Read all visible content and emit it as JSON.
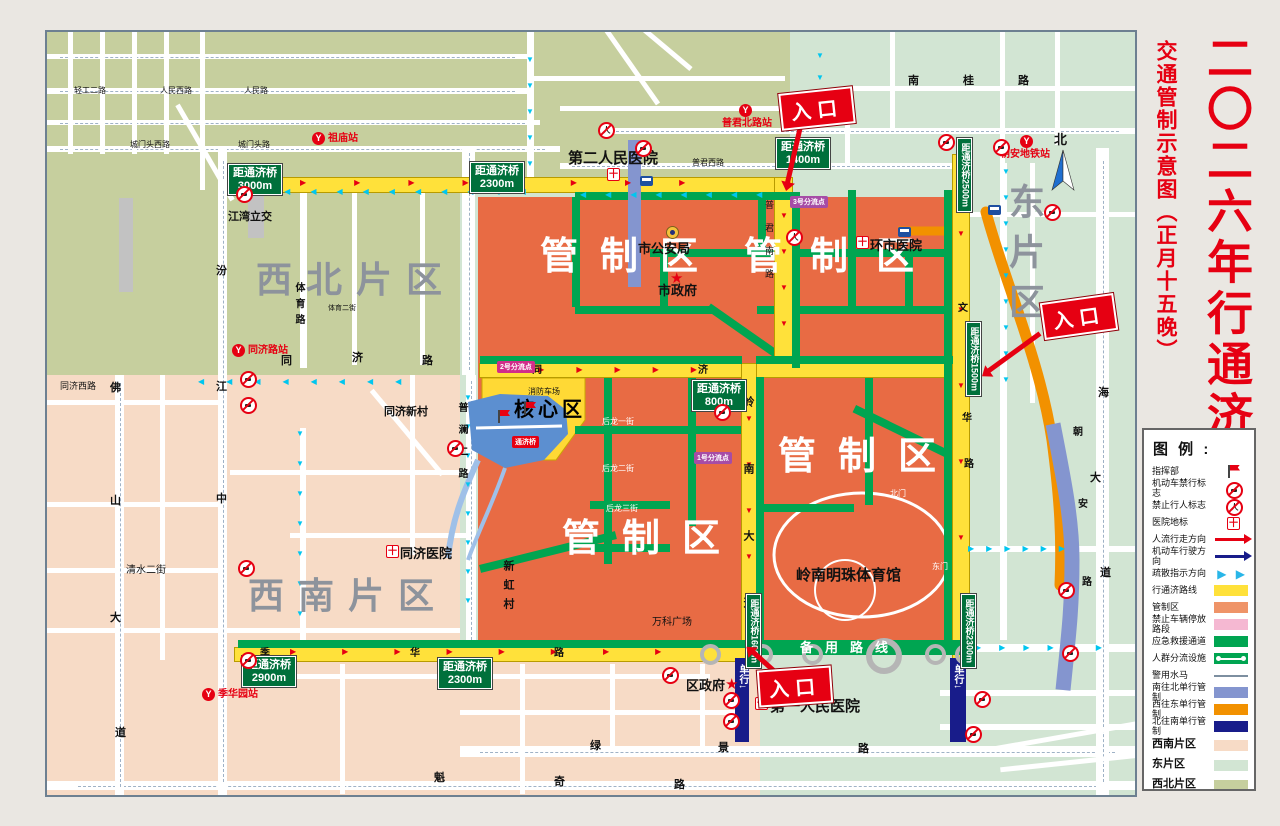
{
  "title": {
    "main": "二〇二六年行通济",
    "sub": "交通管制示意图（正月十五晚）"
  },
  "legend": {
    "heading": "图 例 :",
    "items": [
      {
        "label": "指挥部",
        "icon": "flag"
      },
      {
        "label": "机动车禁行标志",
        "icon": "ring"
      },
      {
        "label": "禁止行人标志",
        "icon": "ringp"
      },
      {
        "label": "医院地标",
        "icon": "hosp"
      },
      {
        "label": "人流行走方向",
        "icon": "arrow",
        "color": "#e60012"
      },
      {
        "label": "机动车行驶方向",
        "icon": "arrow",
        "color": "#181c8a"
      },
      {
        "label": "疏散指示方向",
        "icon": "cyan"
      },
      {
        "label": "行通济路线",
        "icon": "bar",
        "color": "#ffe13a"
      },
      {
        "label": "管制区",
        "icon": "bar",
        "color": "#ef9468"
      },
      {
        "label": "禁止车辆停放路段",
        "icon": "bar",
        "color": "#f5b8d2"
      },
      {
        "label": "应急救援通道",
        "icon": "bar",
        "color": "#00a551"
      },
      {
        "label": "人群分流设施",
        "icon": "dots"
      },
      {
        "label": "警用水马",
        "icon": "line"
      },
      {
        "label": "南往北单行管制",
        "icon": "bar",
        "color": "#8495cf"
      },
      {
        "label": "西往东单行管制",
        "icon": "bar",
        "color": "#f29100"
      },
      {
        "label": "北往南单行管制",
        "icon": "bar",
        "color": "#181c8a"
      },
      {
        "label": "西南片区",
        "icon": "bar",
        "color": "#f7dbc6",
        "tall": true
      },
      {
        "label": "东片区",
        "icon": "bar",
        "color": "#d2e5d3",
        "tall": true
      },
      {
        "label": "西北片区",
        "icon": "bar",
        "color": "#c6cf9e",
        "tall": true
      }
    ],
    "cyan_glyphs": "▶ ▶"
  },
  "glyphs": {
    "station": "Y",
    "hospital": "十",
    "person": "人",
    "star": "★"
  },
  "map": {
    "labels": [
      {
        "t": "西北片区",
        "x": 256,
        "y": 262,
        "c": "big",
        "ls": 14,
        "n": "district-label-northwest"
      },
      {
        "t": "西南片区",
        "x": 248,
        "y": 578,
        "c": "big",
        "ls": 14,
        "n": "district-label-southwest"
      },
      {
        "t": "东片区",
        "x": 1006,
        "y": 183,
        "c": "big",
        "v": 1,
        "ls": 14,
        "n": "district-label-east"
      },
      {
        "t": "管制区",
        "x": 540,
        "y": 238,
        "c": "ctrl",
        "ls": 22,
        "n": "control-zone-label"
      },
      {
        "t": "管制区",
        "x": 744,
        "y": 238,
        "c": "ctrl",
        "ls": 28,
        "n": "control-zone-label"
      },
      {
        "t": "管制区",
        "x": 778,
        "y": 438,
        "c": "ctrl",
        "ls": 22,
        "n": "control-zone-label"
      },
      {
        "t": "管制区",
        "x": 562,
        "y": 520,
        "c": "ctrl",
        "ls": 22,
        "n": "control-zone-label"
      },
      {
        "t": "核心区",
        "x": 514,
        "y": 400,
        "c": "core",
        "ls": 4,
        "n": "core-zone-label"
      },
      {
        "t": "第二人民医院",
        "x": 568,
        "y": 151,
        "c": "lm15",
        "n": "landmark-second-peoples-hospital"
      },
      {
        "t": "第一人民医院",
        "x": 770,
        "y": 699,
        "c": "lm15",
        "n": "landmark-first-peoples-hospital"
      },
      {
        "t": "岭南明珠体育馆",
        "x": 796,
        "y": 568,
        "c": "lm15",
        "n": "landmark-lingnan-pearl-stadium"
      },
      {
        "t": "市公安局",
        "x": 638,
        "y": 242,
        "c": "lm13",
        "n": "landmark-public-security-bureau"
      },
      {
        "t": "市政府",
        "x": 658,
        "y": 284,
        "c": "lm13",
        "n": "landmark-city-government"
      },
      {
        "t": "环市医院",
        "x": 870,
        "y": 239,
        "c": "lm13",
        "n": "landmark-huanshi-hospital"
      },
      {
        "t": "同济医院",
        "x": 400,
        "y": 547,
        "c": "lm13",
        "n": "landmark-tongji-hospital"
      },
      {
        "t": "区政府",
        "x": 686,
        "y": 679,
        "c": "lm13",
        "n": "landmark-district-government"
      },
      {
        "t": "同济新村",
        "x": 384,
        "y": 407,
        "c": "lm11",
        "n": "landmark-tongji-xincun"
      },
      {
        "t": "万科广场",
        "x": 652,
        "y": 618,
        "c": "lm10",
        "n": "landmark-vanke-plaza"
      },
      {
        "t": "江湾立交",
        "x": 228,
        "y": 212,
        "c": "lm11",
        "n": "landmark-jiangwan-interchange"
      },
      {
        "t": "清水二街",
        "x": 126,
        "y": 566,
        "c": "lm10",
        "n": "road-label"
      },
      {
        "t": "同济西路",
        "x": 60,
        "y": 382,
        "c": "lm9",
        "n": "road-label"
      },
      {
        "t": "新虹村",
        "x": 502,
        "y": 560,
        "c": "lm11",
        "v": 1,
        "ls": 8,
        "n": "landmark-xinhong-village"
      },
      {
        "t": "消防车场",
        "x": 528,
        "y": 388,
        "c": "lm8",
        "n": "landmark-fire-truck-area"
      },
      {
        "t": "北门",
        "x": 890,
        "y": 490,
        "c": "lmw8",
        "n": "stadium-north-gate"
      },
      {
        "t": "东门",
        "x": 932,
        "y": 563,
        "c": "lmw8",
        "n": "stadium-east-gate"
      },
      {
        "t": "后龙一街",
        "x": 602,
        "y": 418,
        "c": "lmw8",
        "n": "road-label"
      },
      {
        "t": "后龙二街",
        "x": 602,
        "y": 465,
        "c": "lmw8",
        "n": "road-label"
      },
      {
        "t": "后龙三街",
        "x": 606,
        "y": 505,
        "c": "lmw8",
        "n": "road-label"
      },
      {
        "t": "汾",
        "x": 216,
        "y": 266,
        "c": "rd11",
        "n": "road-label"
      },
      {
        "t": "江",
        "x": 216,
        "y": 382,
        "c": "rd11",
        "n": "road-label"
      },
      {
        "t": "中",
        "x": 216,
        "y": 494,
        "c": "rd11",
        "n": "road-label"
      },
      {
        "t": "体育路",
        "x": 293,
        "y": 282,
        "c": "rd10",
        "v": 1,
        "ls": 6,
        "n": "road-label"
      },
      {
        "t": "同",
        "x": 281,
        "y": 356,
        "c": "rd11",
        "n": "road-label"
      },
      {
        "t": "济",
        "x": 352,
        "y": 353,
        "c": "rd11",
        "n": "road-label"
      },
      {
        "t": "路",
        "x": 422,
        "y": 356,
        "c": "rd11",
        "n": "road-label"
      },
      {
        "t": "同",
        "x": 532,
        "y": 366,
        "c": "rd10",
        "n": "road-label"
      },
      {
        "t": "济",
        "x": 698,
        "y": 366,
        "c": "rd10",
        "n": "road-label"
      },
      {
        "t": "普澜二路",
        "x": 456,
        "y": 402,
        "c": "rd10",
        "v": 1,
        "ls": 12,
        "n": "road-label"
      },
      {
        "t": "岭南大道",
        "x": 742,
        "y": 396,
        "c": "rd11",
        "v": 1,
        "ls": 56,
        "n": "road-label"
      },
      {
        "t": "普君南路",
        "x": 764,
        "y": 200,
        "c": "rd9",
        "v": 1,
        "ls": 14,
        "n": "road-label"
      },
      {
        "t": "文",
        "x": 958,
        "y": 304,
        "c": "rd10",
        "n": "road-label"
      },
      {
        "t": "华",
        "x": 962,
        "y": 414,
        "c": "rd10",
        "n": "road-label"
      },
      {
        "t": "路",
        "x": 964,
        "y": 460,
        "c": "rd10",
        "n": "road-label"
      },
      {
        "t": "朝",
        "x": 1073,
        "y": 428,
        "c": "rd10",
        "n": "road-label"
      },
      {
        "t": "安",
        "x": 1078,
        "y": 500,
        "c": "rd10",
        "n": "road-label"
      },
      {
        "t": "路",
        "x": 1082,
        "y": 578,
        "c": "rd10",
        "n": "road-label"
      },
      {
        "t": "南",
        "x": 1098,
        "y": 304,
        "c": "rd11",
        "n": "road-label"
      },
      {
        "t": "海",
        "x": 1098,
        "y": 388,
        "c": "rd11",
        "n": "road-label"
      },
      {
        "t": "大",
        "x": 1090,
        "y": 473,
        "c": "rd11",
        "n": "road-label"
      },
      {
        "t": "道",
        "x": 1100,
        "y": 568,
        "c": "rd11",
        "n": "road-label"
      },
      {
        "t": "南桂路",
        "x": 908,
        "y": 76,
        "c": "rd11",
        "ls": 44,
        "n": "road-label"
      },
      {
        "t": "季",
        "x": 260,
        "y": 649,
        "c": "rd10",
        "n": "road-label"
      },
      {
        "t": "华",
        "x": 410,
        "y": 649,
        "c": "rd10",
        "n": "road-label"
      },
      {
        "t": "路",
        "x": 554,
        "y": 649,
        "c": "rd10",
        "n": "road-label"
      },
      {
        "t": "绿",
        "x": 590,
        "y": 741,
        "c": "rd11",
        "n": "road-label"
      },
      {
        "t": "景",
        "x": 718,
        "y": 743,
        "c": "rd11",
        "n": "road-label"
      },
      {
        "t": "路",
        "x": 858,
        "y": 744,
        "c": "rd11",
        "n": "road-label"
      },
      {
        "t": "魁",
        "x": 434,
        "y": 773,
        "c": "rd11",
        "n": "road-label"
      },
      {
        "t": "奇",
        "x": 554,
        "y": 777,
        "c": "rd11",
        "n": "road-label"
      },
      {
        "t": "路",
        "x": 674,
        "y": 780,
        "c": "rd11",
        "n": "road-label"
      },
      {
        "t": "雾岗路",
        "x": 20,
        "y": 220,
        "c": "rd10",
        "v": 1,
        "ls": 10,
        "n": "road-label"
      },
      {
        "t": "佛",
        "x": 110,
        "y": 383,
        "c": "rd11",
        "n": "road-label"
      },
      {
        "t": "山",
        "x": 110,
        "y": 496,
        "c": "rd11",
        "n": "road-label"
      },
      {
        "t": "大",
        "x": 110,
        "y": 613,
        "c": "rd11",
        "n": "road-label"
      },
      {
        "t": "道",
        "x": 115,
        "y": 728,
        "c": "rd11",
        "n": "road-label"
      },
      {
        "t": "轻工二路",
        "x": 74,
        "y": 87,
        "c": "rd8",
        "n": "road-label"
      },
      {
        "t": "人民西路",
        "x": 160,
        "y": 87,
        "c": "rd8",
        "n": "road-label"
      },
      {
        "t": "人民路",
        "x": 244,
        "y": 87,
        "c": "rd8",
        "n": "road-label"
      },
      {
        "t": "城门头西路",
        "x": 130,
        "y": 141,
        "c": "rd8",
        "n": "road-label"
      },
      {
        "t": "城门头路",
        "x": 238,
        "y": 141,
        "c": "rd8",
        "n": "road-label"
      },
      {
        "t": "普君西路",
        "x": 692,
        "y": 159,
        "c": "rd8",
        "n": "road-label"
      },
      {
        "t": "体育二街",
        "x": 328,
        "y": 305,
        "c": "rd7",
        "n": "road-label"
      },
      {
        "t": "单行↓",
        "x": 737,
        "y": 664,
        "c": "nvt",
        "v": 1,
        "n": "one-way-label"
      },
      {
        "t": "单行↓",
        "x": 952,
        "y": 664,
        "c": "nvt",
        "v": 1,
        "n": "one-way-label"
      },
      {
        "t": "备用路线",
        "x": 800,
        "y": 641,
        "c": "byl",
        "ls": 12,
        "n": "backup-route-label"
      },
      {
        "t": "北",
        "x": 1054,
        "y": 133,
        "c": "rd13",
        "n": "compass-north-label"
      },
      {
        "t": "★",
        "x": 670,
        "y": 271,
        "c": "star",
        "n": "government-star-icon"
      },
      {
        "t": "★",
        "x": 725,
        "y": 677,
        "c": "star",
        "n": "government-star-icon"
      }
    ],
    "distance_signs": [
      {
        "line1": "距通济桥",
        "dist": "3000m",
        "x": 228,
        "y": 164
      },
      {
        "line1": "距通济桥",
        "dist": "2300m",
        "x": 470,
        "y": 162
      },
      {
        "line1": "距通济桥",
        "dist": "1400m",
        "x": 776,
        "y": 138
      },
      {
        "line1": "距通济桥",
        "dist": "800m",
        "x": 692,
        "y": 380
      },
      {
        "line1": "距通济桥",
        "dist": "2900m",
        "x": 242,
        "y": 656
      },
      {
        "line1": "距通济桥",
        "dist": "2300m",
        "x": 438,
        "y": 658
      },
      {
        "line1": "距通济桥",
        "dist": "2500m",
        "x": 957,
        "y": 138,
        "v": 1
      },
      {
        "line1": "距通济桥",
        "dist": "1500m",
        "x": 966,
        "y": 322,
        "v": 1
      },
      {
        "line1": "距通济桥",
        "dist": "1600m",
        "x": 746,
        "y": 594,
        "v": 1
      },
      {
        "line1": "距通济桥",
        "dist": "2300m",
        "x": 961,
        "y": 594,
        "v": 1
      }
    ],
    "stations": [
      {
        "name": "祖庙站",
        "ix": 312,
        "iy": 132,
        "tx": 328,
        "ty": 134
      },
      {
        "name": "同济路站",
        "ix": 232,
        "iy": 344,
        "tx": 248,
        "ty": 346
      },
      {
        "name": "季华园站",
        "ix": 202,
        "iy": 688,
        "tx": 218,
        "ty": 690
      },
      {
        "name": "普君北路站",
        "ix": 739,
        "iy": 104,
        "tx": 722,
        "ty": 119
      },
      {
        "name": "朝安地铁站",
        "ix": 1020,
        "iy": 135,
        "tx": 1000,
        "ty": 150
      }
    ],
    "entrances": [
      {
        "label": "入口",
        "x": 780,
        "y": 90,
        "r": -6,
        "ax": 800,
        "ay": 126,
        "ar": 103,
        "al": 56
      },
      {
        "label": "入口",
        "x": 1042,
        "y": 298,
        "r": -8,
        "ax": 1040,
        "ay": 331,
        "ar": 144,
        "al": 64
      },
      {
        "label": "入口",
        "x": 758,
        "y": 668,
        "r": -4,
        "ax": 778,
        "ay": 672,
        "ar": 222,
        "al": 34
      }
    ],
    "badges": [
      {
        "t": "3号分流点",
        "x": 790,
        "y": 196,
        "bg": "#a64ca6"
      },
      {
        "t": "1号分流点",
        "x": 694,
        "y": 452,
        "bg": "#a64ca6"
      },
      {
        "t": "2号分流点",
        "x": 497,
        "y": 361,
        "bg": "#d12d8a"
      },
      {
        "t": "通济桥",
        "x": 512,
        "y": 436,
        "bg": "#e60012"
      }
    ],
    "flows": [
      {
        "x": 258,
        "y": 188,
        "n": 11,
        "gap": 28,
        "g": "◀",
        "cl": "cyan"
      },
      {
        "x": 580,
        "y": 191,
        "n": 8,
        "gap": 27,
        "g": "◀",
        "cl": "cyan"
      },
      {
        "x": 198,
        "y": 378,
        "n": 8,
        "gap": 30,
        "g": "◀",
        "cl": "cyan"
      },
      {
        "x": 1002,
        "y": 168,
        "n": 9,
        "gap": 26,
        "g": "▼",
        "cl": "cyan",
        "v": 1
      },
      {
        "x": 464,
        "y": 394,
        "n": 8,
        "gap": 29,
        "g": "▼",
        "cl": "cyan",
        "v": 1
      },
      {
        "x": 296,
        "y": 430,
        "n": 7,
        "gap": 30,
        "g": "▼",
        "cl": "cyan",
        "v": 1
      },
      {
        "x": 526,
        "y": 56,
        "n": 5,
        "gap": 26,
        "g": "▼",
        "cl": "cyan",
        "v": 1
      },
      {
        "x": 816,
        "y": 52,
        "n": 4,
        "gap": 22,
        "g": "▼",
        "cl": "cyan",
        "v": 1
      },
      {
        "x": 968,
        "y": 545,
        "n": 6,
        "gap": 20,
        "g": "▶",
        "cl": "cyan"
      },
      {
        "x": 975,
        "y": 644,
        "n": 6,
        "gap": 26,
        "g": "▶",
        "cl": "cyan"
      },
      {
        "x": 300,
        "y": 179,
        "n": 8,
        "gap": 56,
        "g": "▶",
        "cl": "red"
      },
      {
        "x": 500,
        "y": 366,
        "n": 6,
        "gap": 40,
        "g": "▶",
        "cl": "red"
      },
      {
        "x": 290,
        "y": 648,
        "n": 8,
        "gap": 54,
        "g": "▶",
        "cl": "red"
      },
      {
        "x": 780,
        "y": 212,
        "n": 4,
        "gap": 36,
        "g": "▼",
        "cl": "red",
        "v": 1
      },
      {
        "x": 957,
        "y": 230,
        "n": 5,
        "gap": 76,
        "g": "▼",
        "cl": "red",
        "v": 1
      },
      {
        "x": 745,
        "y": 415,
        "n": 5,
        "gap": 46,
        "g": "▼",
        "cl": "red",
        "v": 1
      }
    ],
    "icons": {
      "rings": [
        [
          236,
          186
        ],
        [
          938,
          134
        ],
        [
          993,
          139
        ],
        [
          1044,
          204
        ],
        [
          635,
          140
        ],
        [
          240,
          371
        ],
        [
          240,
          397
        ],
        [
          447,
          440
        ],
        [
          714,
          404
        ],
        [
          238,
          560
        ],
        [
          240,
          652
        ],
        [
          662,
          667
        ],
        [
          723,
          692
        ],
        [
          723,
          713
        ],
        [
          1058,
          582
        ],
        [
          1062,
          645
        ],
        [
          974,
          691
        ],
        [
          965,
          726
        ]
      ],
      "rings_person": [
        [
          786,
          229
        ],
        [
          598,
          122
        ]
      ],
      "flags": [
        [
          498,
          410
        ],
        [
          524,
          402
        ]
      ],
      "hospitals": [
        [
          607,
          168
        ],
        [
          856,
          236
        ],
        [
          386,
          545
        ],
        [
          755,
          697
        ]
      ],
      "police": [
        [
          666,
          226
        ]
      ],
      "buses": [
        [
          640,
          176
        ],
        [
          898,
          227
        ],
        [
          988,
          205
        ]
      ],
      "gray_rings": [
        [
          700,
          644
        ],
        [
          752,
          644
        ],
        [
          802,
          644
        ],
        [
          866,
          638,
          1
        ],
        [
          925,
          644
        ],
        [
          955,
          644
        ]
      ]
    }
  }
}
